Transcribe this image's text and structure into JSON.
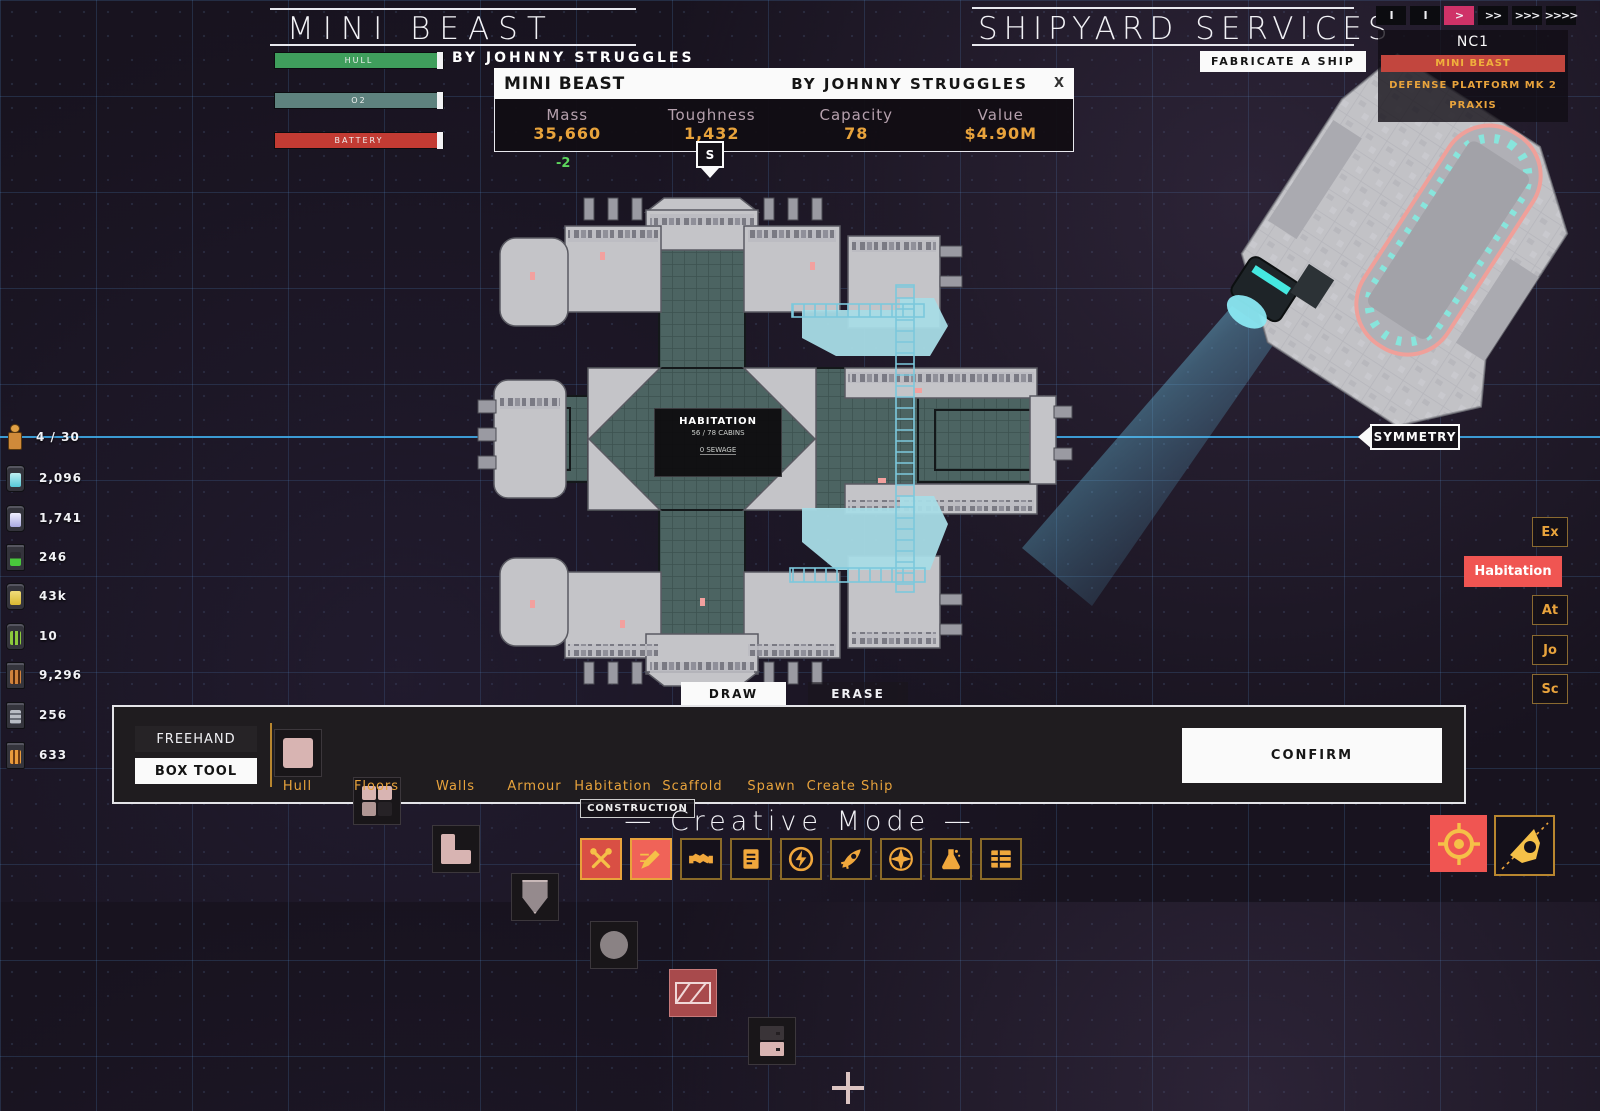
{
  "header": {
    "left": {
      "title": "MINI BEAST",
      "author": "BY JOHNNY STRUGGLES",
      "bars": [
        {
          "label": "HULL",
          "color": "#3F9E5C"
        },
        {
          "label": "O2",
          "color": "#5E827E"
        },
        {
          "label": "BATTERY",
          "color": "#C23B33"
        }
      ]
    },
    "right": {
      "title": "SHIPYARD SERVICES",
      "fabricate": "FABRICATE A SHIP"
    }
  },
  "speed": {
    "items": [
      {
        "label": "I"
      },
      {
        "label": "I"
      },
      {
        "label": ">",
        "active": true
      },
      {
        "label": ">>"
      },
      {
        "label": ">>>"
      },
      {
        "label": ">>>>"
      }
    ]
  },
  "fleet": {
    "title": "NC1",
    "items": [
      {
        "label": "MINI BEAST",
        "selected": true
      },
      {
        "label": "DEFENSE PLATFORM MK 2"
      },
      {
        "label": "PRAXIS"
      }
    ]
  },
  "info": {
    "title": "MINI BEAST",
    "author": "BY JOHNNY STRUGGLES",
    "close": "X",
    "stats": [
      {
        "label": "Mass",
        "value": "35,660"
      },
      {
        "label": "Toughness",
        "value": "1,432"
      },
      {
        "label": "Capacity",
        "value": "78"
      },
      {
        "label": "Value",
        "value": "$4.90M"
      }
    ],
    "marker": "S",
    "delta": "-2"
  },
  "resources": [
    {
      "icon": "crew-icon",
      "value": "4 / 30"
    },
    {
      "icon": "cyan-canister-icon",
      "value": "2,096"
    },
    {
      "icon": "white-canister-icon",
      "value": "1,741"
    },
    {
      "icon": "battery-icon",
      "value": "246"
    },
    {
      "icon": "yellow-canister-icon",
      "value": "43k"
    },
    {
      "icon": "power-cell-icon",
      "value": "10"
    },
    {
      "icon": "metal-rods-icon",
      "value": "9,296"
    },
    {
      "icon": "circuits-icon",
      "value": "256"
    },
    {
      "icon": "fuel-rods-icon",
      "value": "633"
    }
  ],
  "symmetry": {
    "label": "SYMMETRY"
  },
  "side_tabs": [
    {
      "label": "Ex"
    },
    {
      "label": "Habitation",
      "active": true
    },
    {
      "label": "At"
    },
    {
      "label": "Jo"
    },
    {
      "label": "Sc"
    }
  ],
  "tooltip": {
    "title": "HABITATION",
    "cabins": "56 / 78 CABINS",
    "sewage": "0 SEWAGE"
  },
  "mode_tabs": {
    "draw": "DRAW",
    "erase": "ERASE"
  },
  "toolbar": {
    "freehand": "FREEHAND",
    "box_tool": "BOX TOOL",
    "tools": [
      {
        "label": "Hull",
        "icon": "hull-icon"
      },
      {
        "label": "Floors",
        "icon": "floors-icon"
      },
      {
        "label": "Walls",
        "icon": "walls-icon"
      },
      {
        "label": "Armour",
        "icon": "armour-icon"
      },
      {
        "label": "Habitation",
        "icon": "habitation-icon"
      },
      {
        "label": "Scaffold",
        "icon": "scaffold-icon",
        "selected": true
      },
      {
        "label": "Spawn",
        "icon": "spawn-icon"
      },
      {
        "label": "Create Ship",
        "icon": "create-ship-icon"
      }
    ],
    "confirm": "CONFIRM"
  },
  "footer": {
    "construction": "CONSTRUCTION",
    "creative_mode": "— Creative Mode —",
    "dock_icons": [
      "tools-icon",
      "pencil-icon",
      "handshake-icon",
      "document-icon",
      "energy-icon",
      "rocket-icon",
      "compass-icon",
      "flask-icon",
      "table-icon"
    ],
    "corner_icons": [
      "target-icon",
      "ship-pointer-icon"
    ]
  },
  "colors": {
    "accent_orange": "#E8A33C",
    "accent_red": "#E05248",
    "speed_pink": "#CF3268",
    "symmetry_cyan": "#4FB3E8",
    "scaffold_cyan": "#A8DCE6",
    "hull_green": "#3F9E5C",
    "o2_teal": "#5E827E",
    "battery_red": "#C23B33"
  }
}
